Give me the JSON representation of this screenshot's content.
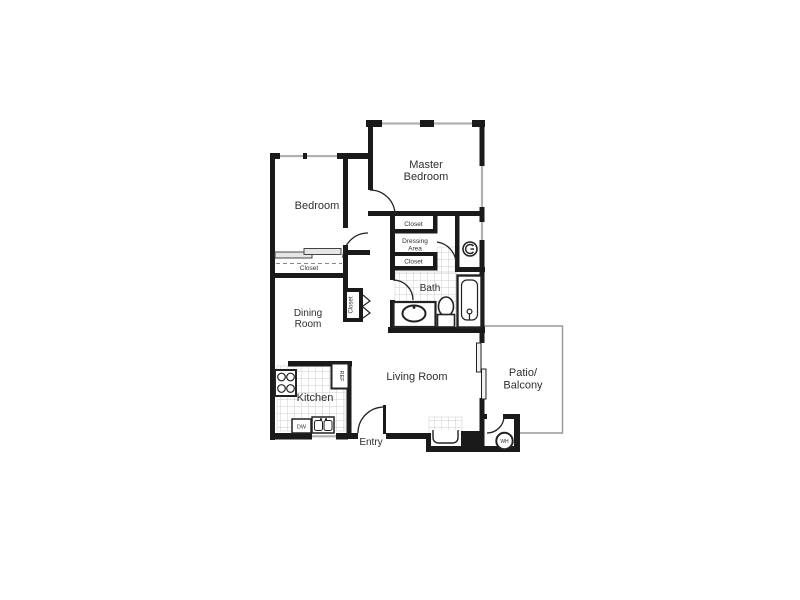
{
  "title": "Two Bedroom Apartment Floor Plan",
  "rooms": {
    "master_bedroom": {
      "line1": "Master",
      "line2": "Bedroom"
    },
    "bedroom": {
      "label": "Bedroom"
    },
    "dining_room": {
      "line1": "Dining",
      "line2": "Room"
    },
    "kitchen": {
      "label": "Kitchen"
    },
    "living_room": {
      "label": "Living Room"
    },
    "bath": {
      "label": "Bath"
    },
    "dressing_area": {
      "line1": "Dressing",
      "line2": "Area"
    },
    "patio": {
      "line1": "Patio/",
      "line2": "Balcony"
    },
    "entry": {
      "label": "Entry"
    }
  },
  "closets": {
    "bedroom_closet": "Closet",
    "dressing_closet_top": "Closet",
    "dressing_closet_bottom": "Closet",
    "hall_closet": "Closet"
  },
  "appliances": {
    "refrigerator": "REF",
    "dishwasher": "DW",
    "water_heater": "WH"
  },
  "colors": {
    "wall": "#1a1a1a",
    "text": "#2e2e2e",
    "tile_line": "#cccccc",
    "window": "#b0b0b0",
    "patio_outline": "#999999",
    "background": "#ffffff"
  }
}
